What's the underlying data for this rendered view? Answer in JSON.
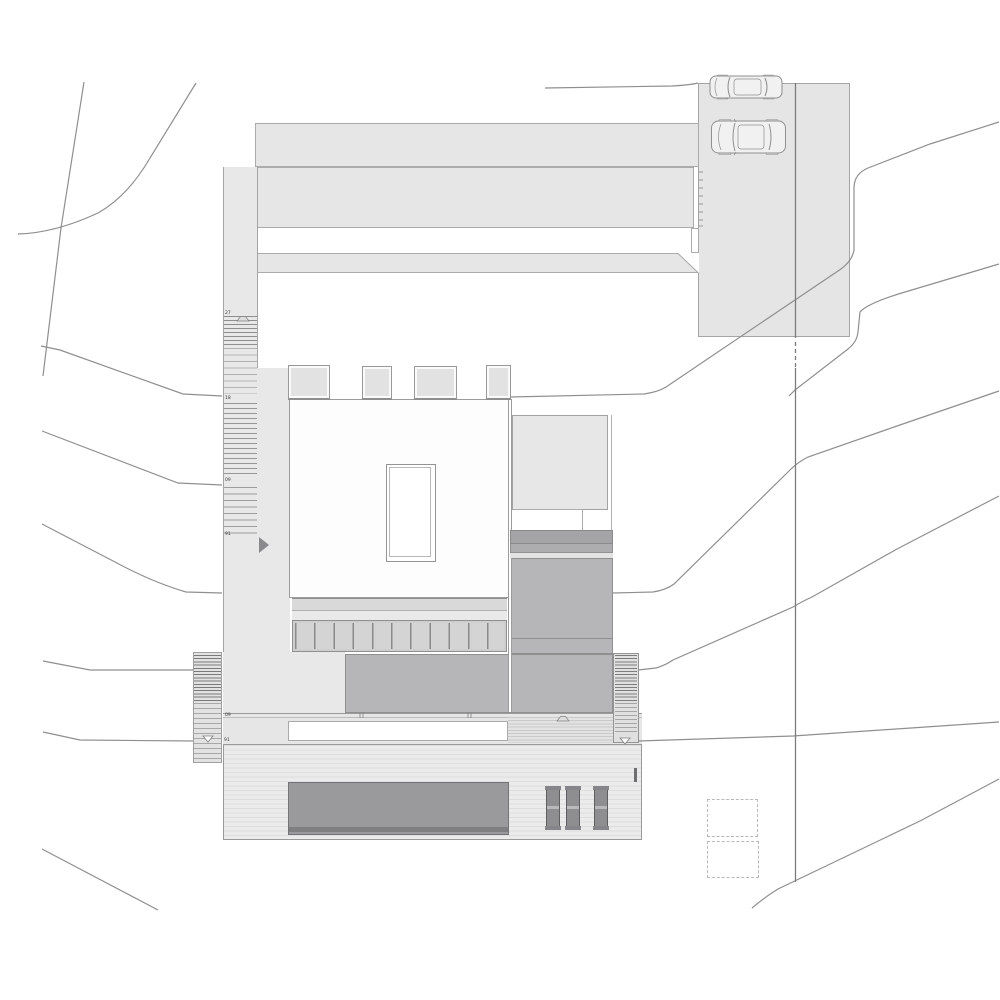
{
  "title": "Residential site plan — roof / site drawing",
  "plan": {
    "stair_labels": {
      "west_top": "27",
      "west_upper": "18",
      "west_mid": "09",
      "west_lower": "91",
      "terrace_upper": "09",
      "terrace_lower": "91"
    },
    "symbols": [
      "benchmark-hat-icon",
      "datum-triangle-icon",
      "entry-arrow-icon",
      "car-top-view-icon",
      "contour-line",
      "property-line",
      "dashed-utility-square"
    ],
    "colors": {
      "paper": "#ffffff",
      "paving_light": "#e6e6e7",
      "roof_white": "#fdfdfe",
      "terrace_gray": "#b6b6b8",
      "dark_band": "#a4a4a6",
      "pool_gray": "#9a9a9c",
      "lounger_gray": "#8e8e90",
      "line_gray": "#8f8f8f"
    },
    "counts": {
      "cars": 2,
      "skylights": 4,
      "loungers": 3,
      "dashed_squares": 2
    }
  }
}
